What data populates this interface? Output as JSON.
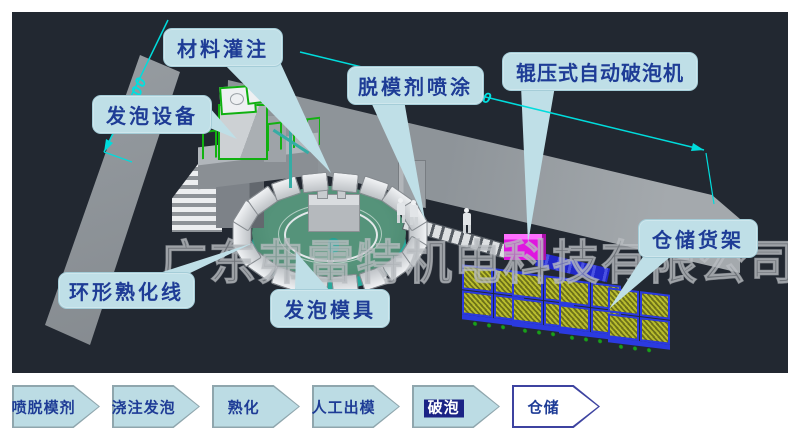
{
  "watermark": "广东弗雷特机电科技有限公司",
  "scene": {
    "callouts": {
      "material_filling": "材料灌注",
      "release_agent_spray": "脱模剂喷涂",
      "roller_breaker": "辊压式自动破泡机",
      "foaming_equipment": "发泡设备",
      "ring_curing_line": "环形熟化线",
      "foam_mold": "发泡模具",
      "storage_rack": "仓储货架"
    },
    "dimensions": {
      "top_label": "000",
      "left_label": "00"
    }
  },
  "flow": {
    "steps": [
      {
        "label": "喷脱模剂",
        "style": "filled"
      },
      {
        "label": "浇注发泡",
        "style": "filled"
      },
      {
        "label": "熟化",
        "style": "filled"
      },
      {
        "label": "人工出模",
        "style": "filled"
      },
      {
        "label": "破泡",
        "style": "filled-highlight"
      },
      {
        "label": "仓储",
        "style": "outline"
      }
    ]
  },
  "colors": {
    "viewport_background": "#222831",
    "callout_fill": "#bfdfe7",
    "callout_text": "#1e3c96",
    "dimension_cyan": "#00e0e0",
    "carousel_teal": "#27a99c",
    "machine_green": "#10b010",
    "breaker_magenta": "#df16df",
    "rack_blue": "#2b3ae0",
    "flow_arrow_fill": "#bcdce4",
    "flow_highlight_bg": "#1b2385",
    "flow_outline_border": "#3d43a0"
  }
}
